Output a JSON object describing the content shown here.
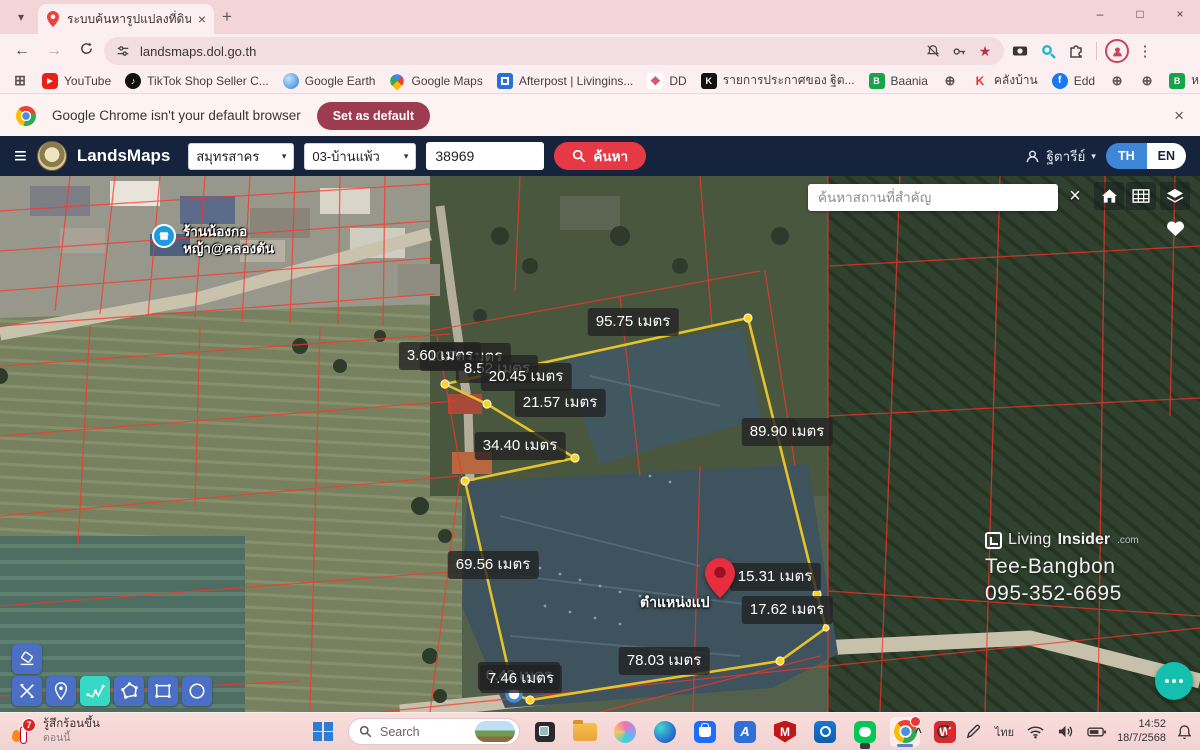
{
  "icons": {
    "hamburger": "≡",
    "caret_down": "▾",
    "tab_search": "▾",
    "new_tab": "+",
    "close": "×",
    "minimize": "–",
    "maximize": "□",
    "back": "←",
    "forward": "→",
    "menu_dots": "⋮",
    "star": "★",
    "apps_grid": "⊞",
    "overflow": "»",
    "chevron_up": "^",
    "play": "▶",
    "note": "♪",
    "globe": "⊕",
    "dd_diamond": "❖"
  },
  "browser": {
    "tab_title": "ระบบค้นหารูปแปลงที่ดิน (LandsMa",
    "url": "landsmaps.dol.go.th",
    "notice": {
      "text": "Google Chrome isn't your default browser",
      "button": "Set as default"
    },
    "bookmarks": [
      {
        "label": "YouTube",
        "glyph": "▶"
      },
      {
        "label": "TikTok Shop Seller C...",
        "glyph": "♪"
      },
      {
        "label": "Google Earth",
        "glyph": ""
      },
      {
        "label": "Google Maps",
        "glyph": ""
      },
      {
        "label": "Afterpost | Livingins...",
        "glyph": ""
      },
      {
        "label": "DD",
        "glyph": "❖"
      },
      {
        "label": "รายการประกาศของ ฐิต...",
        "glyph": "K"
      },
      {
        "label": "Baania",
        "glyph": "B"
      },
      {
        "label": "",
        "glyph": "⊕"
      },
      {
        "label": "คลังบ้าน",
        "glyph": "K"
      },
      {
        "label": "Edd",
        "glyph": "f"
      },
      {
        "label": "",
        "glyph": "⊕"
      },
      {
        "label": "",
        "glyph": "⊕"
      },
      {
        "label": "หาราคาประเมินB",
        "glyph": "B"
      },
      {
        "label": "",
        "glyph": "⊕"
      }
    ],
    "all_bookmarks": "All Bookmarks"
  },
  "app_header": {
    "brand": "LandsMaps",
    "province": "สมุทรสาคร",
    "district": "03-บ้านแพ้ว",
    "parcel": "38969",
    "search_label": "ค้นหา",
    "user": "ฐิตารีย์",
    "lang_th": "TH",
    "lang_en": "EN"
  },
  "map": {
    "search_placeholder": "ค้นหาสถานที่สำคัญ",
    "place": {
      "line1": "ร้านน้องกอ",
      "line2": "หญ้า@คลองตัน"
    },
    "pin_label": "ตำแหน่งแป",
    "watermark": {
      "living": "Living",
      "insider": "Insider",
      "dotcom": ".com",
      "name": "Tee-Bangbon",
      "phone": "095-352-6695"
    },
    "measurements": [
      {
        "text": "10.79 เมตร"
      },
      {
        "text": "3.60 เมตร"
      },
      {
        "text": "8.52 เมตร"
      },
      {
        "text": "20.45 เมตร"
      },
      {
        "text": "95.75 เมตร"
      },
      {
        "text": "21.57 เมตร"
      },
      {
        "text": "34.40 เมตร"
      },
      {
        "text": "89.90 เมตร"
      },
      {
        "text": "69.56 เมตร"
      },
      {
        "text": "15.31 เมตร"
      },
      {
        "text": "17.62 เมตร"
      },
      {
        "text": "78.03 เมตร"
      },
      {
        "text": "0.42 เมตร"
      },
      {
        "text": "7.46 เมตร"
      }
    ]
  },
  "taskbar": {
    "weather": {
      "line1": "รู้สึกร้อนขึ้น",
      "line2": "ตอนนี้",
      "badge": "7"
    },
    "search_label": "Search",
    "apps": {
      "anydesk": "A",
      "mcafee": "M",
      "wps": "W"
    },
    "tray": {
      "lang": "ไทย",
      "time": "14:52",
      "date": "18/7/2568"
    }
  }
}
